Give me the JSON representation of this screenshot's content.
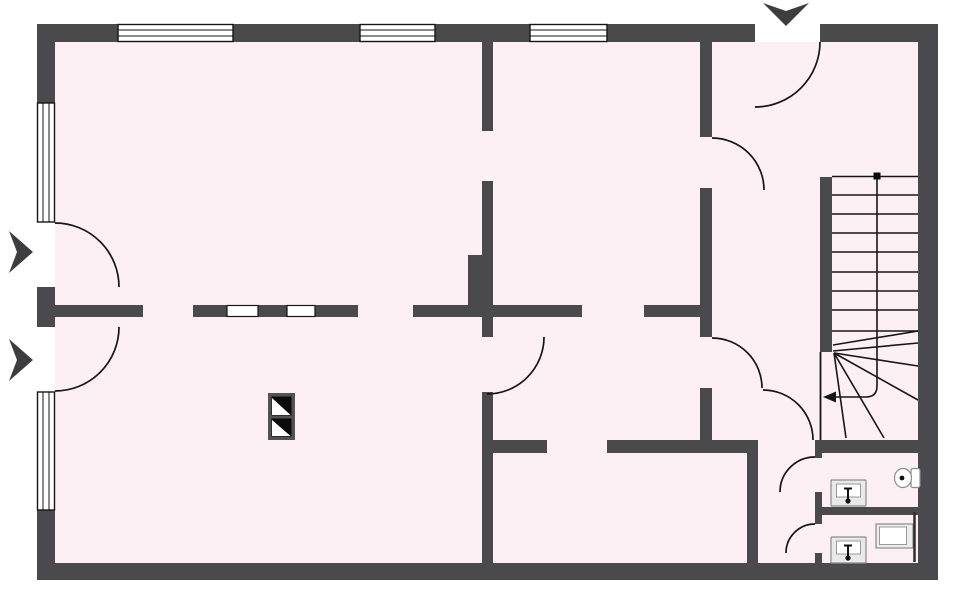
{
  "meta": {
    "type": "architectural-floor-plan",
    "wall_color": "#4a4a4c",
    "floor_color": "#fcf0f4",
    "line_color": "#161616",
    "window_count": 5,
    "door_count": 9,
    "canvas": {
      "width": 960,
      "height": 591
    }
  },
  "floor": [
    {
      "t": "rect",
      "name": "floor-area",
      "x": 55,
      "y": 42,
      "width": 863,
      "height": 521,
      "fill": "#fcf0f4"
    }
  ],
  "walls": [
    {
      "t": "rect",
      "name": "outer-top-wall-seg-1",
      "x": 37,
      "y": 24,
      "width": 81,
      "height": 18,
      "fill": "#4a4a4c"
    },
    {
      "t": "rect",
      "name": "outer-top-wall-seg-2",
      "x": 233,
      "y": 24,
      "width": 127,
      "height": 18,
      "fill": "#4a4a4c"
    },
    {
      "t": "rect",
      "name": "outer-top-wall-seg-3",
      "x": 435,
      "y": 24,
      "width": 95,
      "height": 18,
      "fill": "#4a4a4c"
    },
    {
      "t": "rect",
      "name": "outer-top-wall-seg-4",
      "x": 607,
      "y": 24,
      "width": 148,
      "height": 18,
      "fill": "#4a4a4c"
    },
    {
      "t": "rect",
      "name": "outer-top-wall-seg-5",
      "x": 820,
      "y": 24,
      "width": 118,
      "height": 18,
      "fill": "#4a4a4c"
    },
    {
      "t": "rect",
      "name": "outer-bottom-wall",
      "x": 37,
      "y": 563,
      "width": 901,
      "height": 17,
      "fill": "#4a4a4c"
    },
    {
      "t": "rect",
      "name": "outer-left-wall-seg-1",
      "x": 37,
      "y": 42,
      "width": 18,
      "height": 61,
      "fill": "#4a4a4c"
    },
    {
      "t": "rect",
      "name": "outer-left-wall-seg-2",
      "x": 37,
      "y": 287,
      "width": 18,
      "height": 40,
      "fill": "#4a4a4c"
    },
    {
      "t": "rect",
      "name": "outer-left-wall-seg-3",
      "x": 37,
      "y": 510,
      "width": 18,
      "height": 53,
      "fill": "#4a4a4c"
    },
    {
      "t": "rect",
      "name": "outer-right-wall",
      "x": 918,
      "y": 42,
      "width": 20,
      "height": 521,
      "fill": "#4a4a4c"
    },
    {
      "t": "rect",
      "name": "interior-wall-a-upper",
      "x": 482,
      "y": 42,
      "width": 11,
      "height": 89,
      "fill": "#4a4a4c"
    },
    {
      "t": "rect",
      "name": "interior-wall-a-mid",
      "x": 482,
      "y": 181,
      "width": 11,
      "height": 156,
      "fill": "#4a4a4c"
    },
    {
      "t": "rect",
      "name": "interior-wall-a-lower",
      "x": 482,
      "y": 392,
      "width": 11,
      "height": 171,
      "fill": "#4a4a4c"
    },
    {
      "t": "rect",
      "name": "chimney-breast",
      "x": 468,
      "y": 255,
      "width": 25,
      "height": 52,
      "fill": "#4a4a4c"
    },
    {
      "t": "rect",
      "name": "interior-wall-b-seg-1",
      "x": 55,
      "y": 305,
      "width": 88,
      "height": 12,
      "fill": "#4a4a4c"
    },
    {
      "t": "rect",
      "name": "interior-wall-b-seg-2",
      "x": 193,
      "y": 305,
      "width": 165,
      "height": 12,
      "fill": "#4a4a4c"
    },
    {
      "t": "rect",
      "name": "interior-wall-b-seg-3",
      "x": 413,
      "y": 305,
      "width": 169,
      "height": 12,
      "fill": "#4a4a4c"
    },
    {
      "t": "rect",
      "name": "interior-wall-b-seg-4",
      "x": 644,
      "y": 305,
      "width": 68,
      "height": 12,
      "fill": "#4a4a4c"
    },
    {
      "t": "rect",
      "name": "interior-wall-c-upper",
      "x": 700,
      "y": 42,
      "width": 12,
      "height": 95,
      "fill": "#4a4a4c"
    },
    {
      "t": "rect",
      "name": "interior-wall-c-mid",
      "x": 700,
      "y": 188,
      "width": 12,
      "height": 149,
      "fill": "#4a4a4c"
    },
    {
      "t": "rect",
      "name": "interior-wall-c-lower",
      "x": 700,
      "y": 388,
      "width": 12,
      "height": 65,
      "fill": "#4a4a4c"
    },
    {
      "t": "rect",
      "name": "interior-wall-d-seg-1",
      "x": 493,
      "y": 440,
      "width": 54,
      "height": 13,
      "fill": "#4a4a4c"
    },
    {
      "t": "rect",
      "name": "interior-wall-d-seg-2",
      "x": 607,
      "y": 440,
      "width": 151,
      "height": 13,
      "fill": "#4a4a4c"
    },
    {
      "t": "rect",
      "name": "interior-wall-d-seg-3",
      "x": 815,
      "y": 440,
      "width": 103,
      "height": 13,
      "fill": "#4a4a4c"
    },
    {
      "t": "rect",
      "name": "interior-wall-e",
      "x": 747,
      "y": 440,
      "width": 11,
      "height": 123,
      "fill": "#4a4a4c"
    },
    {
      "t": "rect",
      "name": "stair-side-wall",
      "x": 820,
      "y": 177,
      "width": 12,
      "height": 175,
      "fill": "#4a4a4c"
    },
    {
      "t": "rect",
      "name": "wc-wall-seg-1",
      "x": 815,
      "y": 448,
      "width": 7,
      "height": 10,
      "fill": "#4a4a4c"
    },
    {
      "t": "rect",
      "name": "wc-wall-seg-2",
      "x": 815,
      "y": 492,
      "width": 7,
      "height": 32,
      "fill": "#4a4a4c"
    },
    {
      "t": "rect",
      "name": "wc-wall-seg-3",
      "x": 815,
      "y": 553,
      "width": 7,
      "height": 10,
      "fill": "#4a4a4c"
    },
    {
      "t": "rect",
      "name": "wc-divider-wall",
      "x": 822,
      "y": 507,
      "width": 96,
      "height": 8,
      "fill": "#4a4a4c"
    }
  ],
  "windows": [
    {
      "t": "rect",
      "name": "window-top-1",
      "x": 118,
      "y": 24.5,
      "width": 115,
      "height": 17,
      "fill": "#ffffff",
      "stroke": "#161616",
      "stroke-width": 1.4
    },
    {
      "t": "line",
      "name": "window-top-1-pane",
      "x1": 118,
      "y1": 30,
      "x2": 233,
      "y2": 30,
      "stroke": "#161616",
      "stroke-width": 1
    },
    {
      "t": "line",
      "name": "window-top-1-pane",
      "x1": 118,
      "y1": 36,
      "x2": 233,
      "y2": 36,
      "stroke": "#161616",
      "stroke-width": 1
    },
    {
      "t": "rect",
      "name": "window-top-2",
      "x": 360,
      "y": 24.5,
      "width": 75,
      "height": 17,
      "fill": "#ffffff",
      "stroke": "#161616",
      "stroke-width": 1.4
    },
    {
      "t": "line",
      "name": "window-top-2-pane",
      "x1": 360,
      "y1": 30,
      "x2": 435,
      "y2": 30,
      "stroke": "#161616",
      "stroke-width": 1
    },
    {
      "t": "line",
      "name": "window-top-2-pane",
      "x1": 360,
      "y1": 36,
      "x2": 435,
      "y2": 36,
      "stroke": "#161616",
      "stroke-width": 1
    },
    {
      "t": "rect",
      "name": "window-top-3",
      "x": 530,
      "y": 24.5,
      "width": 77,
      "height": 17,
      "fill": "#ffffff",
      "stroke": "#161616",
      "stroke-width": 1.4
    },
    {
      "t": "line",
      "name": "window-top-3-pane",
      "x1": 530,
      "y1": 30,
      "x2": 607,
      "y2": 30,
      "stroke": "#161616",
      "stroke-width": 1
    },
    {
      "t": "line",
      "name": "window-top-3-pane",
      "x1": 530,
      "y1": 36,
      "x2": 607,
      "y2": 36,
      "stroke": "#161616",
      "stroke-width": 1
    },
    {
      "t": "rect",
      "name": "window-left-1",
      "x": 37.5,
      "y": 103,
      "width": 17,
      "height": 119,
      "fill": "#ffffff",
      "stroke": "#161616",
      "stroke-width": 1.4
    },
    {
      "t": "line",
      "name": "window-left-1-pane",
      "x1": 43,
      "y1": 103,
      "x2": 43,
      "y2": 222,
      "stroke": "#161616",
      "stroke-width": 1
    },
    {
      "t": "line",
      "name": "window-left-1-pane",
      "x1": 49,
      "y1": 103,
      "x2": 49,
      "y2": 222,
      "stroke": "#161616",
      "stroke-width": 1
    },
    {
      "t": "rect",
      "name": "window-left-2",
      "x": 37.5,
      "y": 392,
      "width": 17,
      "height": 118,
      "fill": "#ffffff",
      "stroke": "#161616",
      "stroke-width": 1.4
    },
    {
      "t": "line",
      "name": "window-left-2-pane",
      "x1": 43,
      "y1": 392,
      "x2": 43,
      "y2": 510,
      "stroke": "#161616",
      "stroke-width": 1
    },
    {
      "t": "line",
      "name": "window-left-2-pane",
      "x1": 49,
      "y1": 392,
      "x2": 49,
      "y2": 510,
      "stroke": "#161616",
      "stroke-width": 1
    },
    {
      "t": "rect",
      "name": "glazed-panel-1",
      "x": 227,
      "y": 305.5,
      "width": 31,
      "height": 11,
      "fill": "#ffffff",
      "stroke": "#161616",
      "stroke-width": 1.2
    },
    {
      "t": "rect",
      "name": "glazed-panel-2",
      "x": 287,
      "y": 305.5,
      "width": 28,
      "height": 11,
      "fill": "#ffffff",
      "stroke": "#161616",
      "stroke-width": 1.2
    }
  ],
  "doors": [
    {
      "t": "path",
      "name": "entrance-door-arc",
      "d": "M820,42 A65,65 0 0 1 755,107",
      "fill": "none",
      "stroke": "#161616",
      "stroke-width": 1.7
    },
    {
      "t": "path",
      "name": "foyer-door-arc",
      "d": "M712,138 A52,52 0 0 1 764,190",
      "fill": "none",
      "stroke": "#161616",
      "stroke-width": 1.7
    },
    {
      "t": "path",
      "name": "left-entry-door-upper-arc",
      "d": "M55,223 A64,64 0 0 1 119,287",
      "fill": "none",
      "stroke": "#161616",
      "stroke-width": 1.7
    },
    {
      "t": "path",
      "name": "left-entry-door-lower-arc",
      "d": "M119,327 A64,64 0 0 1 55,391",
      "fill": "none",
      "stroke": "#161616",
      "stroke-width": 1.7
    },
    {
      "t": "path",
      "name": "middle-room-door-arc",
      "d": "M544,337 A57,57 0 0 1 487,394",
      "fill": "none",
      "stroke": "#161616",
      "stroke-width": 1.7
    },
    {
      "t": "path",
      "name": "hall-door-arc",
      "d": "M712,338 A50,50 0 0 1 762,388",
      "fill": "none",
      "stroke": "#161616",
      "stroke-width": 1.7
    },
    {
      "t": "path",
      "name": "corridor-door-arc",
      "d": "M763,390 A50,50 0 0 1 813,440",
      "fill": "none",
      "stroke": "#161616",
      "stroke-width": 1.7
    },
    {
      "t": "path",
      "name": "wc1-door-arc",
      "d": "M815,457 A35,35 0 0 0 780,492",
      "fill": "none",
      "stroke": "#161616",
      "stroke-width": 1.7
    },
    {
      "t": "path",
      "name": "wc2-door-arc",
      "d": "M815,524 A29,29 0 0 0 786,553",
      "fill": "none",
      "stroke": "#161616",
      "stroke-width": 1.7
    }
  ],
  "stairs": [
    {
      "t": "line",
      "name": "stair-top-edge",
      "x1": 832,
      "y1": 176.5,
      "x2": 918,
      "y2": 176.5,
      "stroke": "#161616",
      "stroke-width": 1.6
    },
    {
      "t": "line",
      "name": "stair-tread",
      "x1": 832,
      "y1": 195,
      "x2": 918,
      "y2": 195,
      "stroke": "#161616",
      "stroke-width": 1.6
    },
    {
      "t": "line",
      "name": "stair-tread",
      "x1": 832,
      "y1": 214,
      "x2": 918,
      "y2": 214,
      "stroke": "#161616",
      "stroke-width": 1.6
    },
    {
      "t": "line",
      "name": "stair-tread",
      "x1": 832,
      "y1": 233,
      "x2": 918,
      "y2": 233,
      "stroke": "#161616",
      "stroke-width": 1.6
    },
    {
      "t": "line",
      "name": "stair-tread",
      "x1": 832,
      "y1": 252,
      "x2": 918,
      "y2": 252,
      "stroke": "#161616",
      "stroke-width": 1.6
    },
    {
      "t": "line",
      "name": "stair-tread",
      "x1": 832,
      "y1": 272,
      "x2": 918,
      "y2": 272,
      "stroke": "#161616",
      "stroke-width": 1.6
    },
    {
      "t": "line",
      "name": "stair-tread",
      "x1": 832,
      "y1": 291,
      "x2": 918,
      "y2": 291,
      "stroke": "#161616",
      "stroke-width": 1.6
    },
    {
      "t": "line",
      "name": "stair-tread",
      "x1": 832,
      "y1": 310,
      "x2": 918,
      "y2": 310,
      "stroke": "#161616",
      "stroke-width": 1.6
    },
    {
      "t": "line",
      "name": "stair-tread",
      "x1": 832,
      "y1": 331,
      "x2": 918,
      "y2": 331,
      "stroke": "#161616",
      "stroke-width": 1.6
    },
    {
      "t": "line",
      "name": "stair-winder",
      "x1": 833,
      "y1": 345,
      "x2": 918,
      "y2": 331,
      "stroke": "#161616",
      "stroke-width": 1.6
    },
    {
      "t": "line",
      "name": "stair-winder",
      "x1": 833,
      "y1": 351,
      "x2": 918,
      "y2": 343,
      "stroke": "#161616",
      "stroke-width": 1.6
    },
    {
      "t": "line",
      "name": "stair-winder",
      "x1": 834,
      "y1": 353,
      "x2": 918,
      "y2": 366,
      "stroke": "#161616",
      "stroke-width": 1.6
    },
    {
      "t": "line",
      "name": "stair-winder",
      "x1": 834,
      "y1": 353,
      "x2": 918,
      "y2": 400,
      "stroke": "#161616",
      "stroke-width": 1.6
    },
    {
      "t": "line",
      "name": "stair-winder",
      "x1": 834,
      "y1": 353,
      "x2": 884,
      "y2": 438,
      "stroke": "#161616",
      "stroke-width": 1.6
    },
    {
      "t": "line",
      "name": "stair-winder",
      "x1": 834,
      "y1": 353,
      "x2": 846,
      "y2": 438,
      "stroke": "#161616",
      "stroke-width": 1.6
    },
    {
      "t": "line",
      "name": "stair-open-edge",
      "x1": 820.5,
      "y1": 352,
      "x2": 820.5,
      "y2": 440,
      "stroke": "#161616",
      "stroke-width": 1.8
    },
    {
      "t": "path",
      "name": "stair-walking-line",
      "d": "M877,178 L877,386 Q877,397 866,397 L836,397",
      "fill": "none",
      "stroke": "#161616",
      "stroke-width": 1.6
    },
    {
      "t": "polygon",
      "name": "stair-direction-arrow",
      "points": "823,397 836,391.5 836,402.5",
      "fill": "#161616"
    },
    {
      "t": "rect",
      "name": "stair-start-dot",
      "x": 873.5,
      "y": 172.5,
      "width": 7,
      "height": 7,
      "fill": "#0a0a0a"
    }
  ],
  "symbols": [
    {
      "t": "rect",
      "name": "chimney-body",
      "x": 268,
      "y": 393,
      "width": 27,
      "height": 47,
      "fill": "#525254"
    },
    {
      "t": "rect",
      "name": "chimney-flue-1",
      "x": 271.5,
      "y": 396.5,
      "width": 20,
      "height": 19,
      "fill": "#0a0a0a"
    },
    {
      "t": "polygon",
      "name": "chimney-flue-1-vent",
      "points": "272,398 272,415 290.5,415",
      "fill": "#ffffff"
    },
    {
      "t": "rect",
      "name": "chimney-flue-2",
      "x": 271.5,
      "y": 418.5,
      "width": 20,
      "height": 18,
      "fill": "#0a0a0a"
    },
    {
      "t": "polygon",
      "name": "chimney-flue-2-vent",
      "points": "272,420 272,436 290.5,436",
      "fill": "#ffffff"
    },
    {
      "t": "polygon",
      "name": "entrance-arrow",
      "points": "763,3 786,11 809,3 786,26",
      "fill": "#3d3d3f"
    },
    {
      "t": "polygon",
      "name": "left-entry-arrow-upper",
      "points": "9,231 33,252 9,273 17,252",
      "fill": "#3d3d3f"
    },
    {
      "t": "polygon",
      "name": "left-entry-arrow-lower",
      "points": "9,339 33,360 9,381 17,360",
      "fill": "#3d3d3f"
    }
  ],
  "fixtures": [
    {
      "t": "rect",
      "name": "wc1-sink-body",
      "x": 831,
      "y": 480,
      "width": 35,
      "height": 26,
      "rx": 1,
      "fill": "#e9e9e9",
      "stroke": "#8c8c8c",
      "stroke-width": 1.2
    },
    {
      "t": "rect",
      "name": "wc1-sink-basin",
      "x": 836.5,
      "y": 484,
      "width": 24,
      "height": 13,
      "fill": "#ffffff",
      "stroke": "#9a9a9a",
      "stroke-width": 1
    },
    {
      "t": "line",
      "name": "wc1-sink-tap-bar",
      "x1": 844,
      "y1": 488.5,
      "x2": 852,
      "y2": 488.5,
      "stroke": "#111111",
      "stroke-width": 2
    },
    {
      "t": "line",
      "name": "wc1-sink-tap",
      "x1": 848,
      "y1": 488,
      "x2": 848,
      "y2": 500,
      "stroke": "#111111",
      "stroke-width": 2
    },
    {
      "t": "circle",
      "name": "wc1-sink-tap-dot",
      "cx": 848,
      "cy": 501,
      "r": 2.6,
      "fill": "#111111"
    },
    {
      "t": "rect",
      "name": "wc2-sink-body",
      "x": 831,
      "y": 537,
      "width": 35,
      "height": 26,
      "rx": 1,
      "fill": "#e9e9e9",
      "stroke": "#8c8c8c",
      "stroke-width": 1.2
    },
    {
      "t": "rect",
      "name": "wc2-sink-basin",
      "x": 836.5,
      "y": 541,
      "width": 24,
      "height": 13,
      "fill": "#ffffff",
      "stroke": "#9a9a9a",
      "stroke-width": 1
    },
    {
      "t": "line",
      "name": "wc2-sink-tap-bar",
      "x1": 844,
      "y1": 545.5,
      "x2": 852,
      "y2": 545.5,
      "stroke": "#111111",
      "stroke-width": 2
    },
    {
      "t": "line",
      "name": "wc2-sink-tap",
      "x1": 848,
      "y1": 545,
      "x2": 848,
      "y2": 557,
      "stroke": "#111111",
      "stroke-width": 2
    },
    {
      "t": "circle",
      "name": "wc2-sink-tap-dot",
      "cx": 848,
      "cy": 558,
      "r": 2.6,
      "fill": "#111111"
    },
    {
      "t": "rect",
      "name": "wc1-toilet-tank",
      "x": 911,
      "y": 468.5,
      "width": 9,
      "height": 19,
      "rx": 2,
      "fill": "#ffffff",
      "stroke": "#8c8c8c",
      "stroke-width": 1.2
    },
    {
      "t": "ellipse",
      "name": "wc1-toilet-bowl",
      "cx": 903,
      "cy": 478,
      "rx": 8.5,
      "ry": 9.5,
      "fill": "#ffffff",
      "stroke": "#8c8c8c",
      "stroke-width": 1.2
    },
    {
      "t": "circle",
      "name": "wc1-toilet-dot",
      "cx": 902,
      "cy": 478,
      "r": 2.4,
      "fill": "#111111"
    },
    {
      "t": "rect",
      "name": "wc2-shower-body",
      "x": 876,
      "y": 524,
      "width": 37,
      "height": 24,
      "fill": "#ededed",
      "stroke": "#8c8c8c",
      "stroke-width": 1.2
    },
    {
      "t": "rect",
      "name": "wc2-shower-tray",
      "x": 879.5,
      "y": 527,
      "width": 27,
      "height": 17.5,
      "fill": "#ffffff",
      "stroke": "#9a9a9a",
      "stroke-width": 1
    },
    {
      "t": "line",
      "name": "wc2-partition",
      "x1": 914.5,
      "y1": 512,
      "x2": 914.5,
      "y2": 562,
      "stroke": "#2e2e2e",
      "stroke-width": 2.5
    }
  ]
}
